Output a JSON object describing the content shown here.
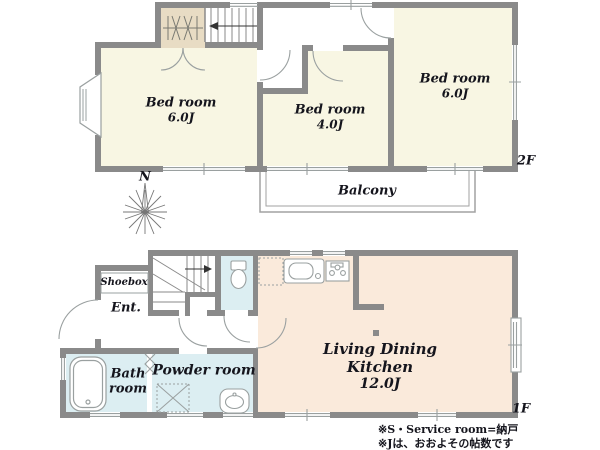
{
  "colors": {
    "wall": "#8a8a8a",
    "bedroom_fill": "#f8f6e3",
    "ldk_fill": "#faeadb",
    "wet_room_fill": "#dceef2",
    "closet_fill": "#e8dcc4",
    "text": "#15151d"
  },
  "floor2": {
    "label": "2F",
    "compass": "N",
    "balcony": "Balcony",
    "bedroom_left": {
      "name": "Bed room",
      "size": "6.0J"
    },
    "bedroom_middle": {
      "name": "Bed room",
      "size": "4.0J"
    },
    "bedroom_right": {
      "name": "Bed room",
      "size": "6.0J"
    }
  },
  "floor1": {
    "label": "1F",
    "shoebox": "Shoebox",
    "entrance": "Ent.",
    "bath": {
      "line1": "Bath",
      "line2": "room"
    },
    "powder": "Powder room",
    "ldk": {
      "line1": "Living Dining",
      "line2": "Kitchen",
      "size": "12.0J"
    }
  },
  "footnotes": [
    "※S・Service room=納戸",
    "※Jは、おおよその帖数です"
  ]
}
